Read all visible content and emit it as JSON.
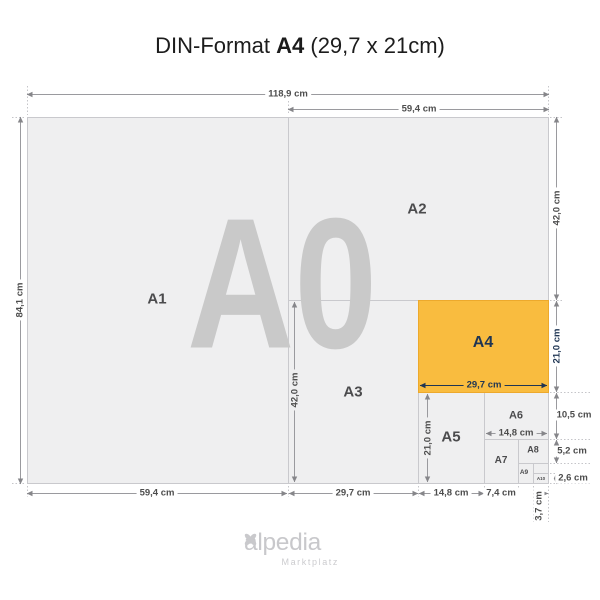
{
  "title": {
    "prefix": "DIN-Format ",
    "format": "A4",
    "suffix": " (29,7 x 21cm)"
  },
  "diagram": {
    "watermark": "A0",
    "formats": {
      "a1": "A1",
      "a2": "A2",
      "a3": "A3",
      "a4": "A4",
      "a5": "A5",
      "a6": "A6",
      "a7": "A7",
      "a8": "A8",
      "a9": "A9",
      "a10": "A10"
    },
    "dims": {
      "a0_w": "118,9 cm",
      "a2_w_top": "59,4 cm",
      "a0_h": "84,1 cm",
      "a2_h": "42,0 cm",
      "a4_h": "21,0 cm",
      "a6_h": "10,5 cm",
      "a8_h": "5,2 cm",
      "a10_h": "2,6 cm",
      "a1_w": "59,4 cm",
      "a3_w": "29,7 cm",
      "a5_w": "14,8 cm",
      "a7_w": "7,4 cm",
      "a10_w": "3,7 cm",
      "a3_h": "42,0 cm",
      "a4_w": "29,7 cm",
      "a5_h": "21,0 cm",
      "a6_w": "14,8 cm"
    }
  },
  "footer": {
    "logo_text": "alpedia",
    "logo_tagline": "Marktplatz",
    "logo_icon": "four-petal-clover"
  },
  "colors": {
    "accent_orange": "#f9bc3f",
    "navy": "#1f3553",
    "panel_gray": "#efeff0",
    "watermark_gray": "#c9c9c9"
  }
}
